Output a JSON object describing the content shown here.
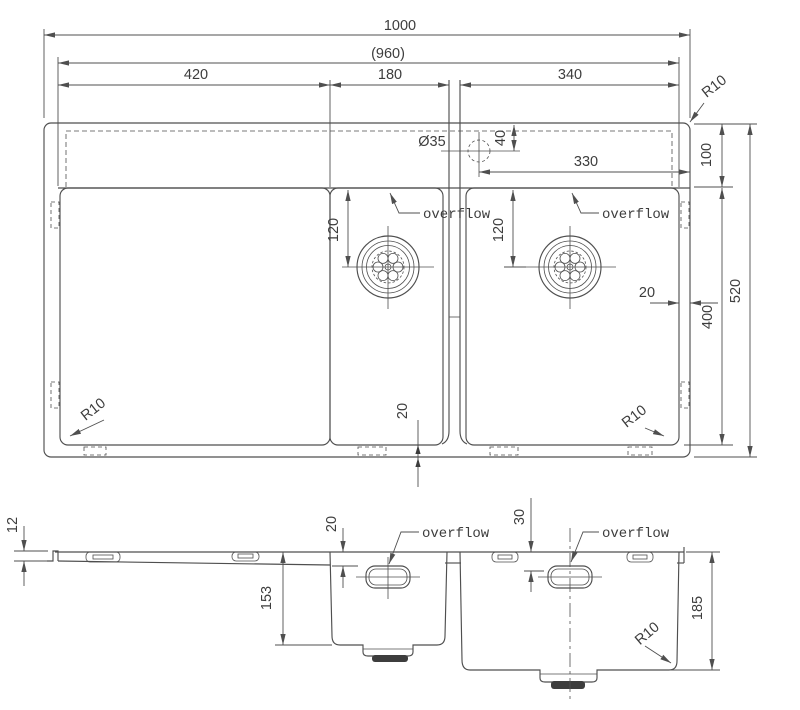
{
  "drawing": {
    "background": "#ffffff",
    "line_color": "#4f4f4f",
    "text_color": "#3d3d3d",
    "top_view": {
      "overall_width": "1000",
      "inner_width": "(960)",
      "drainboard_width": "420",
      "small_bowl_width": "180",
      "large_bowl_width": "340",
      "corner_radius_top_right": "R10",
      "faucet_hole_diameter": "Ø35",
      "faucet_hole_offset": "40",
      "faucet_to_edge": "330",
      "deck_depth": "100",
      "small_bowl_drain_offset": "120",
      "large_bowl_drain_offset": "120",
      "small_bowl_overflow_label": "overflow",
      "large_bowl_overflow_label": "overflow",
      "edge_gap_right": "20",
      "bowl_depth_plan": "400",
      "overall_depth": "520",
      "edge_gap_bottom": "20",
      "corner_radius_bottom_left": "R10",
      "corner_radius_bottom_right": "R10"
    },
    "section_view": {
      "rim_height": "12",
      "small_bowl_overflow_offset": "20",
      "small_bowl_overflow_label": "overflow",
      "large_bowl_overflow_offset": "30",
      "large_bowl_overflow_label": "overflow",
      "small_bowl_depth": "153",
      "large_bowl_depth": "185",
      "bowl_corner_radius": "R10"
    }
  }
}
